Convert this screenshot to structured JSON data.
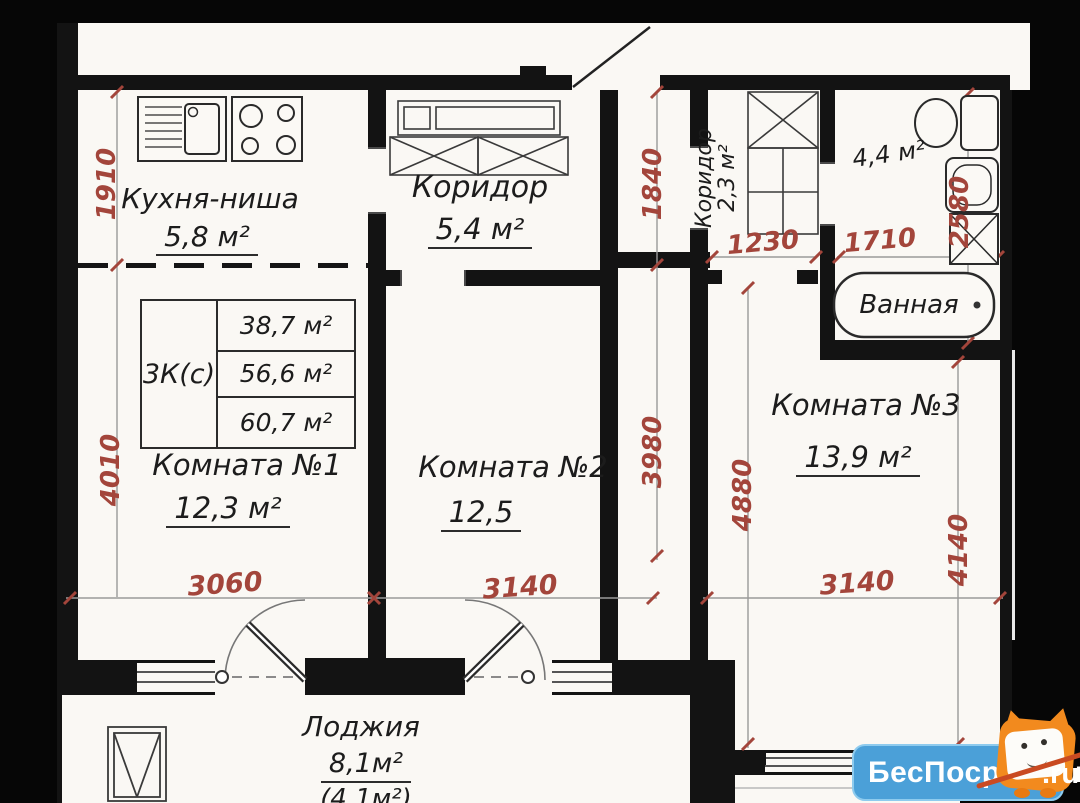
{
  "meta": {
    "type": "apartment floor plan"
  },
  "summary_table": {
    "type_code": "3К(с)",
    "rows": [
      "38,7 м²",
      "56,6 м²",
      "60,7 м²"
    ]
  },
  "rooms": {
    "kitchen": {
      "label": "Кухня-ниша",
      "area": "5,8 м²"
    },
    "hall_main": {
      "label": "Коридор",
      "area": "5,4 м²"
    },
    "hall_small": {
      "label": "Коридор",
      "area": "2,3 м²"
    },
    "bathroom": {
      "label": "Ванная",
      "area": "4,4 м²"
    },
    "room1": {
      "label": "Комната №1",
      "area": "12,3 м²"
    },
    "room2": {
      "label": "Комната №2",
      "area": "12,5"
    },
    "room3": {
      "label": "Комната №3",
      "area": "13,9 м²"
    },
    "loggia": {
      "label": "Лоджия",
      "area": "8,1м²",
      "area_secondary": "(4,1м²)"
    }
  },
  "dimensions_mm": {
    "kitchen_height": "1910",
    "room1_height": "4010",
    "room1_width": "3060",
    "hall_height": "1840",
    "room2_height": "3980",
    "room2_width": "3140",
    "hall_small_width": "1230",
    "bathroom_width": "1710",
    "bathroom_height": "2580",
    "room3_height_left": "4880",
    "room3_height_right": "4140",
    "room3_width": "3140"
  },
  "icons": [
    "kitchen-sink-icon",
    "stove-icon",
    "wardrobe-icon",
    "toilet-icon",
    "washbasin-icon",
    "washing-machine-icon",
    "bathtub-icon",
    "window-icon",
    "door-swing-icon",
    "owl-mascot-icon"
  ],
  "colors": {
    "wall": "#131313",
    "dimension_red": "#a3453b",
    "paper": "#faf8f4",
    "watermark_blue": "#4ba0d8",
    "mascot_orange": "#f28a1e"
  },
  "watermark": {
    "brand": "БесПосредника",
    "tld": ".ru"
  }
}
